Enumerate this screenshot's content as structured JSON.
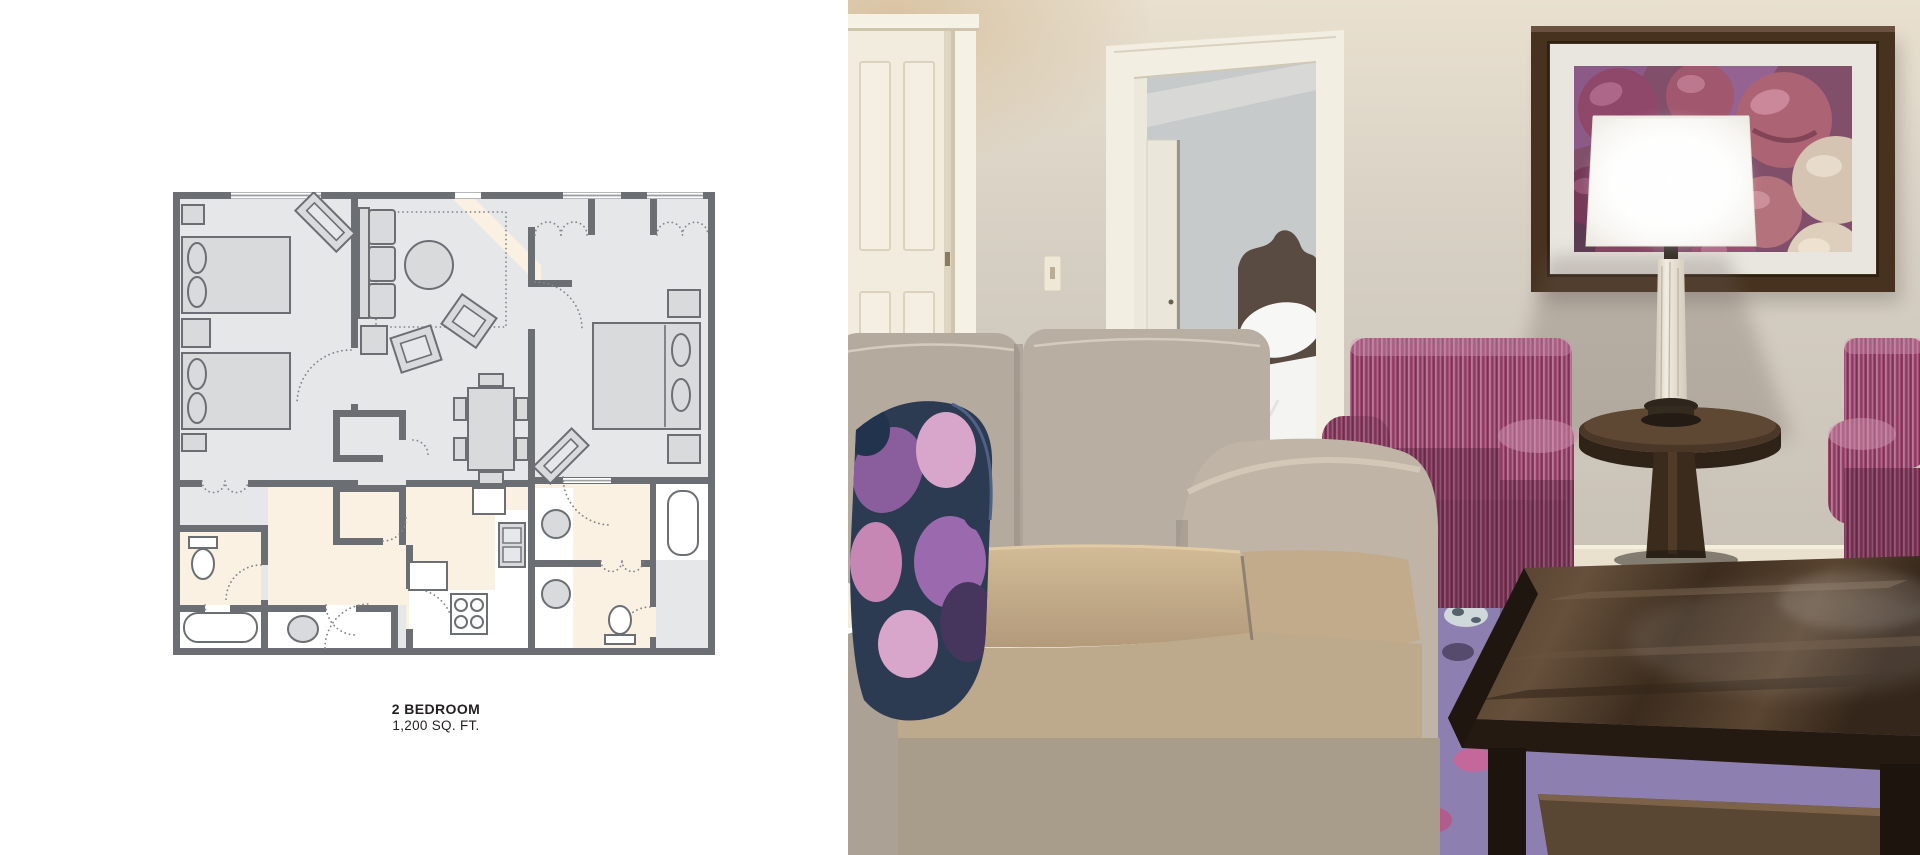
{
  "window": {
    "width_px": 1920,
    "height_px": 855,
    "background": "#ffffff"
  },
  "floorplan_panel": {
    "caption_title": "2 BEDROOM",
    "caption_subtitle": "1,200 SQ. FT.",
    "palette": {
      "wall": "#6b6f74",
      "room_floor": "#e6e7e9",
      "wet_room_floor": "#faf1e2",
      "furniture_fill": "#d9dadc",
      "fixture_fill": "#ffffff",
      "text": "#231f20",
      "background": "#ffffff"
    }
  },
  "photo_panel": {
    "subject": "two-bedroom suite living room photograph",
    "palette": {
      "wall": "#cfc8bc",
      "wall_top": "#e9e0cf",
      "tan_corner": "#d8c3a3",
      "door_white": "#f2ecdf",
      "trim_white": "#f5f0e4",
      "bedroom_wall": "#c7cacb",
      "headboard_brown": "#594a42",
      "bedding_white": "#f4f4f2",
      "sofa_body": "#b7aea1",
      "sofa_seat_gold": "#c7b08f",
      "pillow_navy": "#2c3a52",
      "pillow_purple": "#8a5d9c",
      "pillow_pink": "#d9a6cb",
      "chair_magenta": "#9c486d",
      "chair_stripe_light": "#c583a4",
      "wood_dark": "#3a2b1d",
      "rug_purple": "#8d80b0",
      "rug_spot_pink": "#c4679a",
      "art_frame": "#47321f",
      "art_mat": "#e9e6e0",
      "art_foil_purple": "#8a5588",
      "truffle_rose": "#a85b6c",
      "truffle_cream": "#d6c9b6",
      "lamp_shade": "#fdfdfb",
      "lamp_column_marble": "#e9e2d5",
      "baseboard": "#e9e1ce"
    }
  }
}
